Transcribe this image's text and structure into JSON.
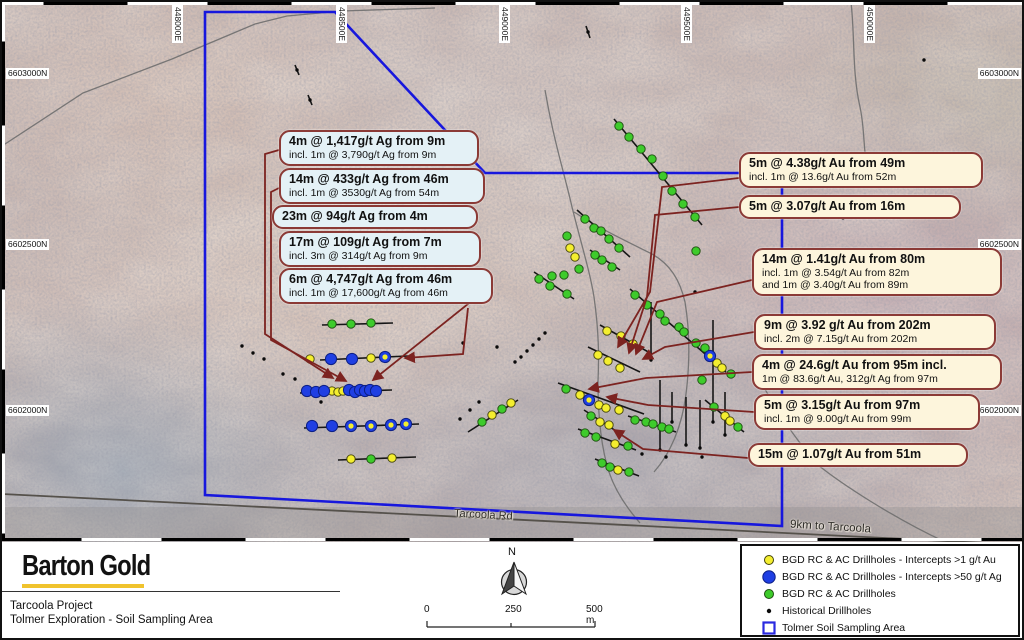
{
  "map": {
    "grid_labels_top": [
      "448000E",
      "448500E",
      "449000E",
      "449500E",
      "450000E"
    ],
    "grid_top_x": [
      170,
      334,
      497,
      679,
      862
    ],
    "grid_labels_side": [
      "6603000N",
      "6602500N",
      "6602000N"
    ],
    "grid_side_y": [
      66,
      237,
      403
    ],
    "road_label": "Tarcoola Rd",
    "road_note": "9km to Tarcoola",
    "polygon_points": "203,10 333,10 483,171 780,171 780,524 203,493",
    "road": [
      0,
      492,
      1024,
      543
    ],
    "tracks": [
      "M0,144 L81,91 L170,57 L253,22 L285,14 L340,9 L433,6",
      "M543,88 C552,140 562,170 570,205 C580,245 588,270 592,295 C597,330 597,355 596,380 C596,415 599,445 607,470 C613,488 624,505 638,521",
      "M572,210 C600,228 626,240 650,252 C668,262 678,278 683,300 C688,330 688,360 684,392 C680,425 668,452 652,470",
      "M849,0 C853,35 850,70 858,105 C863,128 861,148 866,172",
      "M755,372 C770,402 792,436 816,463 C841,483 892,516 941,539"
    ],
    "callouts_left": [
      {
        "x": 277,
        "y": 128,
        "w": 180,
        "lines": [
          "4m @ 1,417g/t Ag from 9m",
          "incl. 1m @ 3,790g/t Ag from 9m"
        ]
      },
      {
        "x": 277,
        "y": 166,
        "w": 186,
        "lines": [
          "14m @ 433g/t Ag from 46m",
          "incl. 1m @ 3530g/t Ag from 54m"
        ]
      },
      {
        "x": 270,
        "y": 203,
        "w": 186,
        "lines": [
          "23m @ 94g/t Ag from 4m"
        ]
      },
      {
        "x": 277,
        "y": 229,
        "w": 182,
        "lines": [
          "17m @ 109g/t Ag from 7m",
          "incl. 3m @ 314g/t Ag from 9m"
        ]
      },
      {
        "x": 277,
        "y": 266,
        "w": 194,
        "lines": [
          "6m @ 4,747g/t Ag from 46m",
          "incl. 1m @ 17,600g/t Ag from 46m"
        ]
      }
    ],
    "callouts_right": [
      {
        "x": 737,
        "y": 150,
        "w": 224,
        "lines": [
          "5m @ 4.38g/t Au from 49m",
          "incl. 1m @ 13.6g/t Au from 52m"
        ]
      },
      {
        "x": 737,
        "y": 193,
        "w": 202,
        "lines": [
          "5m @ 3.07g/t Au from 16m"
        ]
      },
      {
        "x": 750,
        "y": 246,
        "w": 230,
        "lines": [
          "14m @ 1.41g/t Au from 80m",
          "incl. 1m @ 3.54g/t Au from 82m",
          "and 1m @ 3.40g/t Au from 89m"
        ]
      },
      {
        "x": 752,
        "y": 312,
        "w": 222,
        "lines": [
          "9m @ 3.92 g/t Au from 202m",
          "incl. 2m @ 7.15g/t Au from 202m"
        ]
      },
      {
        "x": 750,
        "y": 352,
        "w": 230,
        "lines": [
          "4m @ 24.6g/t Au from 95m incl.",
          "1m @ 83.6g/t Au, 312g/t Ag from 97m"
        ]
      },
      {
        "x": 752,
        "y": 392,
        "w": 206,
        "lines": [
          "5m @ 3.15g/t Au from 97m",
          "incl. 1m @ 9.00g/t Au from 99m"
        ]
      },
      {
        "x": 746,
        "y": 441,
        "w": 200,
        "lines": [
          "15m @ 1.07g/t Au from 51m"
        ]
      }
    ],
    "leaders": [
      "277,148 263,152 263,332 331,376",
      "277,186 269,190 269,338 344,379",
      "470,292 466,302 371,378",
      "466,306 461,352 403,356",
      "737,176 660,185 648,290 616,345",
      "737,205 653,213 645,295 627,351",
      "750,278 655,300 634,352",
      "752,330 663,345 641,357",
      "750,370 644,376 587,387",
      "752,410 646,403 605,395",
      "746,456 641,447 612,428"
    ],
    "traces": [
      [
        320,
        323,
        391,
        321
      ],
      [
        318,
        358,
        406,
        354
      ],
      [
        298,
        391,
        390,
        388
      ],
      [
        302,
        426,
        417,
        422
      ],
      [
        336,
        458,
        414,
        455
      ],
      [
        612,
        117,
        700,
        223
      ],
      [
        575,
        208,
        628,
        255
      ],
      [
        532,
        270,
        572,
        297
      ],
      [
        588,
        248,
        618,
        268
      ],
      [
        598,
        323,
        650,
        352
      ],
      [
        586,
        345,
        638,
        370
      ],
      [
        556,
        381,
        642,
        412
      ],
      [
        582,
        408,
        614,
        429
      ],
      [
        626,
        414,
        674,
        430
      ],
      [
        576,
        427,
        634,
        448
      ],
      [
        593,
        457,
        637,
        474
      ],
      [
        628,
        287,
        724,
        370
      ],
      [
        703,
        398,
        742,
        430
      ],
      [
        466,
        430,
        516,
        398
      ],
      [
        293,
        63,
        297,
        73
      ],
      [
        306,
        93,
        310,
        103
      ],
      [
        584,
        24,
        588,
        36
      ],
      [
        649,
        300,
        649,
        358
      ],
      [
        658,
        378,
        658,
        448
      ],
      [
        670,
        390,
        670,
        420
      ],
      [
        684,
        395,
        684,
        443
      ],
      [
        698,
        398,
        698,
        446
      ],
      [
        711,
        318,
        711,
        420
      ],
      [
        723,
        390,
        723,
        433
      ]
    ],
    "drillholes": {
      "green": [
        [
          330,
          322
        ],
        [
          349,
          322
        ],
        [
          369,
          321
        ],
        [
          617,
          124
        ],
        [
          627,
          135
        ],
        [
          639,
          147
        ],
        [
          650,
          157
        ],
        [
          661,
          174
        ],
        [
          670,
          189
        ],
        [
          681,
          202
        ],
        [
          693,
          215
        ],
        [
          694,
          249
        ],
        [
          583,
          217
        ],
        [
          592,
          226
        ],
        [
          599,
          229
        ],
        [
          607,
          237
        ],
        [
          617,
          246
        ],
        [
          593,
          253
        ],
        [
          600,
          258
        ],
        [
          610,
          265
        ],
        [
          577,
          267
        ],
        [
          565,
          234
        ],
        [
          562,
          273
        ],
        [
          550,
          274
        ],
        [
          537,
          277
        ],
        [
          548,
          284
        ],
        [
          565,
          292
        ],
        [
          633,
          293
        ],
        [
          645,
          303
        ],
        [
          658,
          312
        ],
        [
          663,
          319
        ],
        [
          677,
          325
        ],
        [
          682,
          330
        ],
        [
          694,
          341
        ],
        [
          703,
          346
        ],
        [
          729,
          372
        ],
        [
          564,
          387
        ],
        [
          589,
          414
        ],
        [
          633,
          418
        ],
        [
          644,
          420
        ],
        [
          651,
          422
        ],
        [
          660,
          425
        ],
        [
          667,
          427
        ],
        [
          583,
          431
        ],
        [
          594,
          435
        ],
        [
          626,
          444
        ],
        [
          600,
          461
        ],
        [
          608,
          465
        ],
        [
          627,
          470
        ],
        [
          712,
          405
        ],
        [
          736,
          425
        ],
        [
          700,
          378
        ],
        [
          480,
          420
        ],
        [
          500,
          407
        ],
        [
          369,
          457
        ]
      ],
      "yellow": [
        [
          308,
          357
        ],
        [
          369,
          356
        ],
        [
          330,
          389
        ],
        [
          336,
          390
        ],
        [
          341,
          389
        ],
        [
          349,
          457
        ],
        [
          390,
          456
        ],
        [
          568,
          246
        ],
        [
          573,
          255
        ],
        [
          605,
          329
        ],
        [
          619,
          334
        ],
        [
          631,
          342
        ],
        [
          596,
          353
        ],
        [
          606,
          359
        ],
        [
          618,
          366
        ],
        [
          578,
          393
        ],
        [
          597,
          403
        ],
        [
          604,
          406
        ],
        [
          617,
          408
        ],
        [
          598,
          420
        ],
        [
          607,
          423
        ],
        [
          613,
          442
        ],
        [
          616,
          468
        ],
        [
          715,
          361
        ],
        [
          720,
          366
        ],
        [
          723,
          414
        ],
        [
          728,
          419
        ],
        [
          490,
          413
        ],
        [
          509,
          401
        ]
      ],
      "blue": [
        [
          329,
          357
        ],
        [
          350,
          357
        ],
        [
          305,
          389
        ],
        [
          314,
          390
        ],
        [
          322,
          389
        ],
        [
          347,
          388
        ],
        [
          353,
          390
        ],
        [
          358,
          388
        ],
        [
          363,
          389
        ],
        [
          368,
          388
        ],
        [
          374,
          389
        ],
        [
          310,
          424
        ],
        [
          330,
          424
        ]
      ],
      "blue_ring": [
        [
          383,
          355
        ],
        [
          349,
          424
        ],
        [
          369,
          424
        ],
        [
          389,
          423
        ],
        [
          404,
          422
        ],
        [
          587,
          398
        ],
        [
          708,
          354
        ]
      ],
      "historical": [
        [
          295,
          68
        ],
        [
          308,
          98
        ],
        [
          240,
          344
        ],
        [
          251,
          351
        ],
        [
          262,
          357
        ],
        [
          281,
          372
        ],
        [
          293,
          377
        ],
        [
          319,
          400
        ],
        [
          458,
          417
        ],
        [
          468,
          408
        ],
        [
          477,
          400
        ],
        [
          519,
          355
        ],
        [
          525,
          349
        ],
        [
          531,
          343
        ],
        [
          537,
          337
        ],
        [
          543,
          331
        ],
        [
          513,
          360
        ],
        [
          461,
          341
        ],
        [
          495,
          345
        ],
        [
          841,
          216
        ],
        [
          693,
          290
        ],
        [
          649,
          358
        ],
        [
          658,
          448
        ],
        [
          670,
          420
        ],
        [
          684,
          443
        ],
        [
          698,
          446
        ],
        [
          711,
          420
        ],
        [
          723,
          433
        ],
        [
          664,
          455
        ],
        [
          640,
          452
        ],
        [
          700,
          455
        ],
        [
          586,
          30
        ],
        [
          922,
          58
        ]
      ]
    }
  },
  "footer": {
    "logo": "Barton Gold",
    "project_line1": "Tarcoola Project",
    "project_line2": "Tolmer Exploration - Soil Sampling Area",
    "north_label": "N",
    "scale_ticks": [
      "0",
      "250",
      "500 m"
    ],
    "legend": [
      {
        "marker": "yellow-dot",
        "label": "BGD RC & AC Drillholes - Intercepts >1 g/t Au"
      },
      {
        "marker": "blue-dot",
        "label": "BGD RC & AC Drillholes - Intercepts >50 g/t Ag"
      },
      {
        "marker": "green-dot",
        "label": "BGD RC & AC Drillholes"
      },
      {
        "marker": "black-dot",
        "label": "Historical Drillholes"
      },
      {
        "marker": "blue-square",
        "label": "Tolmer Soil Sampling Area"
      }
    ]
  },
  "colors": {
    "soil_polygon_blue": "#1717dd",
    "leader_red": "#7c2320",
    "callout_border": "#8b3a36",
    "callout_fill_ag": "#e4f1f6",
    "callout_fill_au": "#fdf5dc",
    "dot_green": "#3ecb2b",
    "dot_yellow": "#f4ee2f",
    "dot_blue": "#1f3fe3",
    "dot_black": "#0a0a0a",
    "road_gray": "#55514b",
    "track_gray": "#6e6e6e",
    "logo_yellow": "#f0c32d"
  }
}
